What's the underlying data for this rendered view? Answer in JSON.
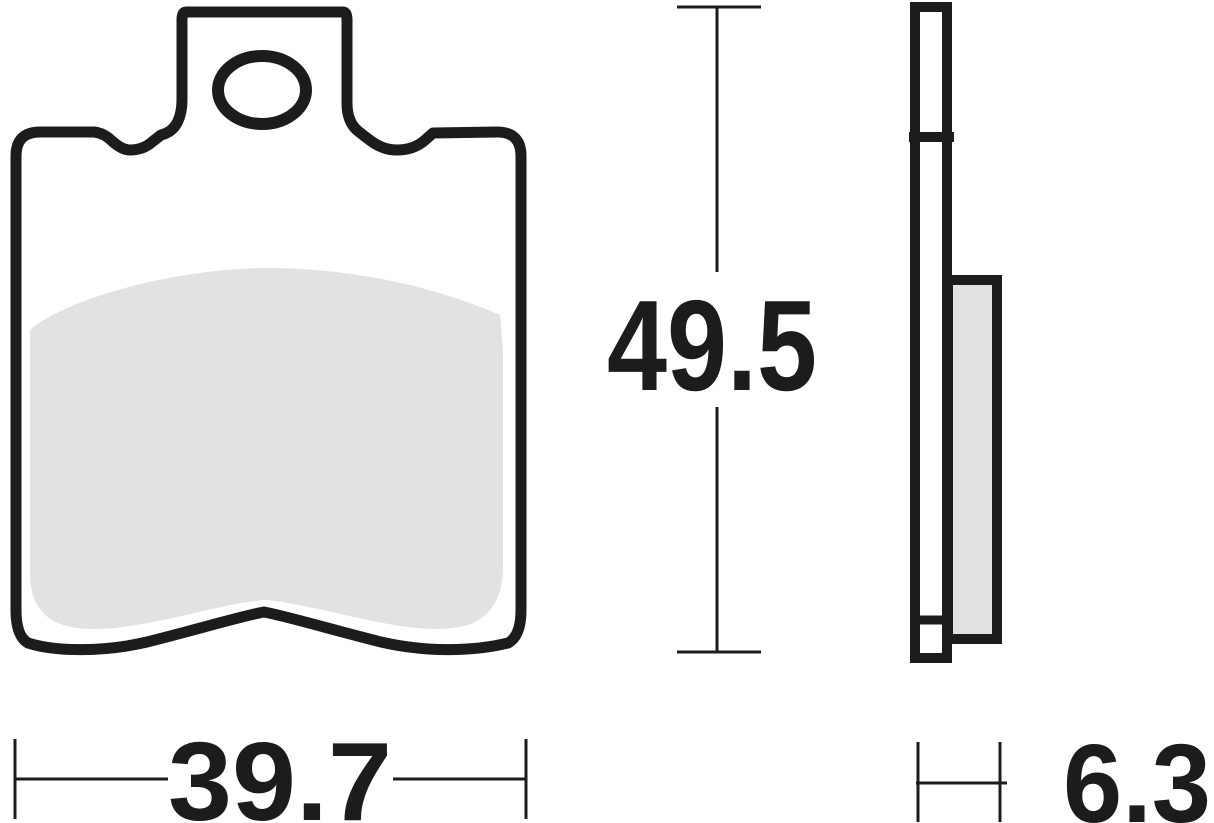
{
  "drawing": {
    "type": "technical-drawing",
    "subject": "brake pad front and side views with dimensions",
    "colors": {
      "line": "#1c1c1c",
      "friction_material": "#e2e2e2",
      "background": "#ffffff"
    },
    "dimensions": {
      "height": {
        "value": "49.5"
      },
      "width": {
        "value": "39.7"
      },
      "thickness": {
        "value": "6.3"
      }
    }
  }
}
